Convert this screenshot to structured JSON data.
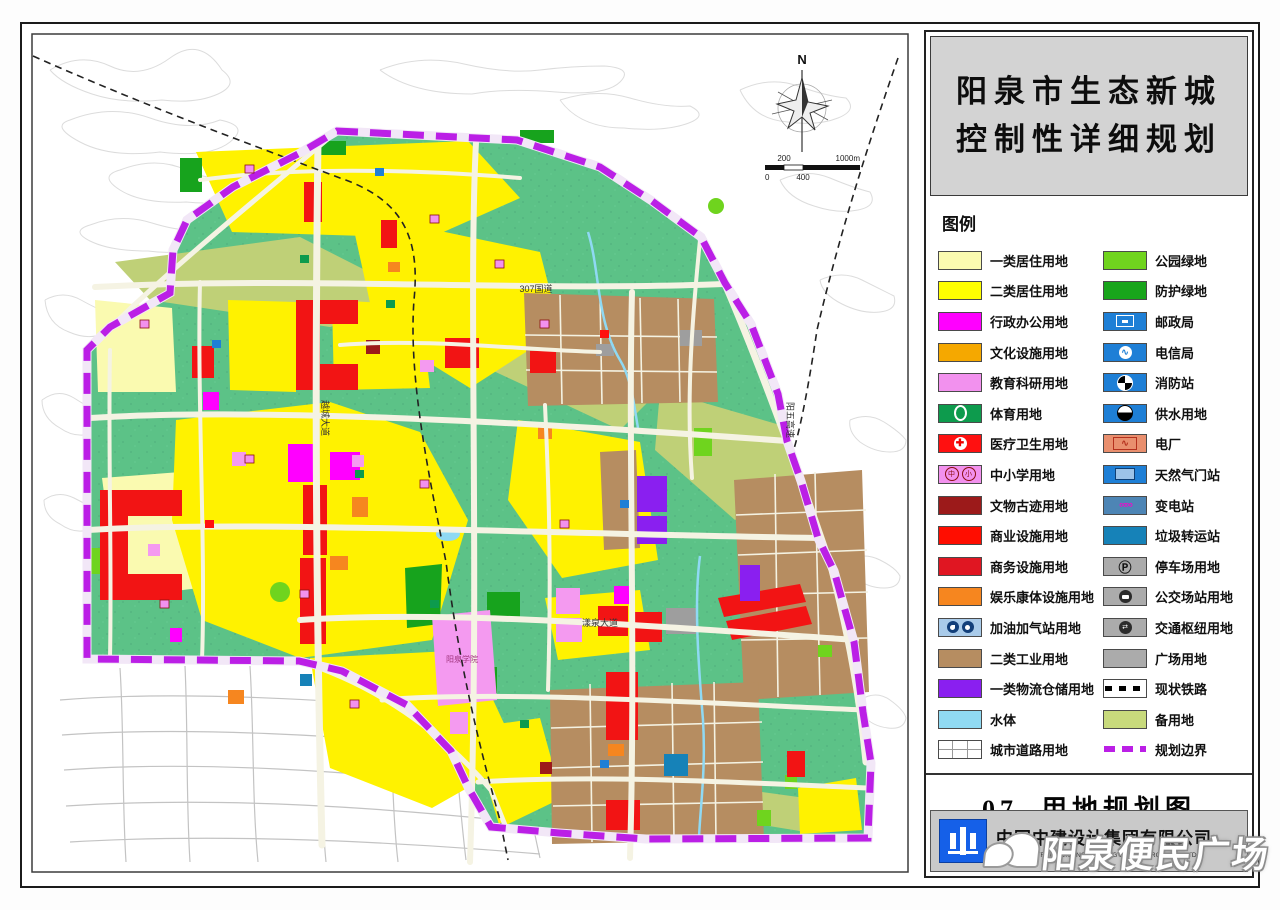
{
  "panel": {
    "title_line1": "阳泉市生态新城",
    "title_line2": "控制性详细规划",
    "legend_title": "图例",
    "map_number": "07",
    "map_name": "用地规划图",
    "company_name": "中国中建设计集团有限公司",
    "company_name_en": "CHINA CONSTRUCTION ENGINEERING DESIGN GROUP CO.,LTD",
    "legend_left": [
      {
        "label": "一类居住用地",
        "color": "#fafab0",
        "icon": "none"
      },
      {
        "label": "二类居住用地",
        "color": "#ffff00",
        "icon": "none"
      },
      {
        "label": "行政办公用地",
        "color": "#ff00ff",
        "icon": "none"
      },
      {
        "label": "文化设施用地",
        "color": "#f5a800",
        "icon": "none"
      },
      {
        "label": "教育科研用地",
        "color": "#f291ee",
        "icon": "none"
      },
      {
        "label": "体育用地",
        "color": "#0d9b4d",
        "icon": "stadium-ring"
      },
      {
        "label": "医疗卫生用地",
        "color": "#ff1010",
        "icon": "medical-cross"
      },
      {
        "label": "中小学用地",
        "color": "#f291ee",
        "icon": "school-circles"
      },
      {
        "label": "文物古迹用地",
        "color": "#9c1a1a",
        "icon": "none"
      },
      {
        "label": "商业设施用地",
        "color": "#ff0d00",
        "icon": "none"
      },
      {
        "label": "商务设施用地",
        "color": "#e01622",
        "icon": "none"
      },
      {
        "label": "娱乐康体设施用地",
        "color": "#f6861f",
        "icon": "none"
      },
      {
        "label": "加油加气站用地",
        "color": "#a9cbea",
        "icon": "gas-pumps"
      },
      {
        "label": "二类工业用地",
        "color": "#b68d61",
        "icon": "none"
      },
      {
        "label": "一类物流仓储用地",
        "color": "#8a1ff0",
        "icon": "none"
      },
      {
        "label": "水体",
        "color": "#90daf3",
        "icon": "none"
      },
      {
        "label": "城市道路用地",
        "color": "#ffffff",
        "icon": "road-grid"
      }
    ],
    "legend_right": [
      {
        "label": "公园绿地",
        "color": "#70d41e",
        "icon": "none"
      },
      {
        "label": "防护绿地",
        "color": "#18a51b",
        "icon": "none"
      },
      {
        "label": "邮政局",
        "color": "#1e7fd6",
        "icon": "post"
      },
      {
        "label": "电信局",
        "color": "#1e7fd6",
        "icon": "telecom"
      },
      {
        "label": "消防站",
        "color": "#1e7fd6",
        "icon": "fire-station"
      },
      {
        "label": "供水用地",
        "color": "#1e7fd6",
        "icon": "water-supply"
      },
      {
        "label": "电厂",
        "color": "#e98f6e",
        "icon": "power-plant"
      },
      {
        "label": "天然气门站",
        "color": "#1e7fd6",
        "icon": "gas-gate"
      },
      {
        "label": "变电站",
        "color": "#4d85b5",
        "icon": "substation"
      },
      {
        "label": "垃圾转运站",
        "color": "#1682b8",
        "icon": "none"
      },
      {
        "label": "停车场用地",
        "color": "#ababab",
        "icon": "parking"
      },
      {
        "label": "公交场站用地",
        "color": "#ababab",
        "icon": "bus"
      },
      {
        "label": "交通枢纽用地",
        "color": "#ababab",
        "icon": "transport-hub"
      },
      {
        "label": "广场用地",
        "color": "#ababab",
        "icon": "none"
      },
      {
        "label": "现状铁路",
        "color": "#ffffff",
        "icon": "railway"
      },
      {
        "label": "备用地",
        "color": "#c8da7c",
        "icon": "none"
      },
      {
        "label": "规划边界",
        "color": "#ffffff",
        "icon": "boundary"
      }
    ]
  },
  "map": {
    "north_label": "N",
    "scale": {
      "t200": "200",
      "t1000": "1000m",
      "b0": "0",
      "b400": "400"
    },
    "labels": {
      "g307": "307国道",
      "yuecheng": "越城大道",
      "yangquan_ave": "漾泉大道",
      "yangwu": "阳五高速",
      "college": "阳泉学院"
    }
  },
  "watermark": {
    "text": "阳泉便民广场"
  },
  "colors": {
    "boundary": "#bb1fe6",
    "site_green": "#5cc287",
    "reserve": "#bfd077",
    "industry": "#b68d61",
    "residential2": "#fff200",
    "residential1": "#fafab0",
    "commercial": "#f21414",
    "admin": "#ff00ff",
    "education": "#f49af0",
    "logistics": "#8a1ff0",
    "water": "#8fd9f3",
    "road": "#f5f3e3"
  }
}
